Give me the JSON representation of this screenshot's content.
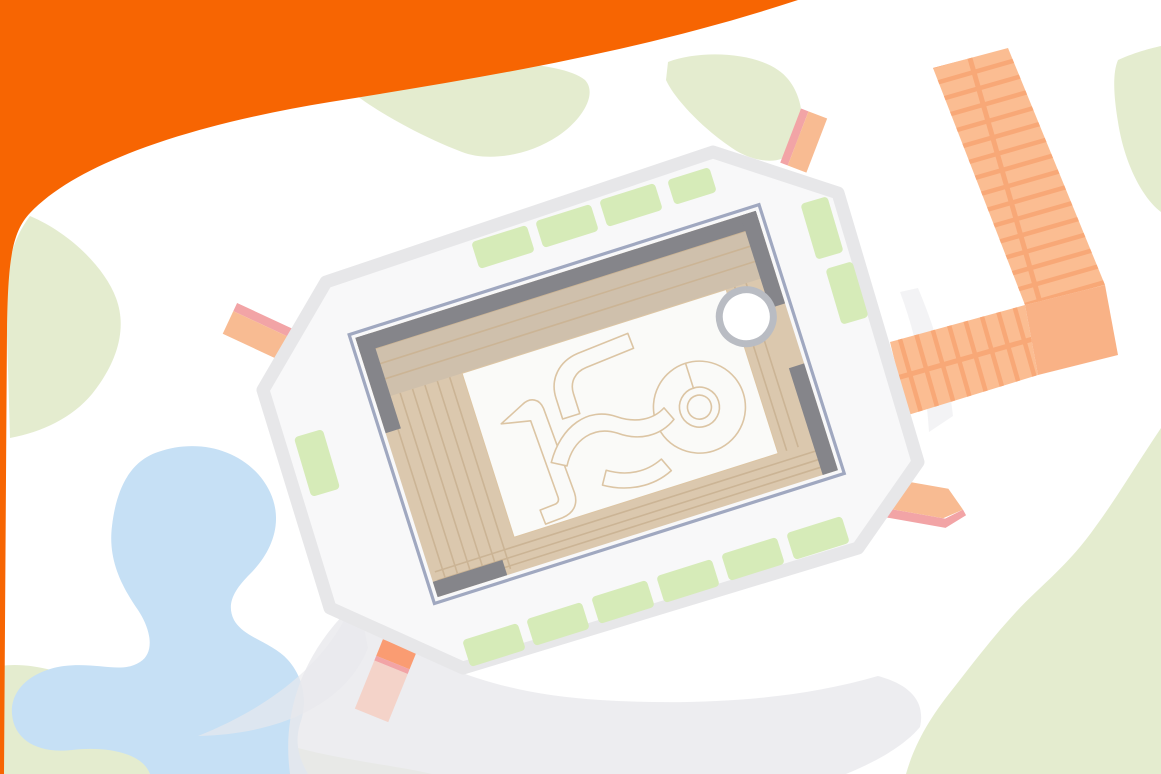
{
  "title": "Aerial site plan illustration",
  "colors": {
    "banner": "#F76502",
    "grass": "#E4ECCF",
    "planter": "#D6EBB8",
    "pond": "#C6E0F5",
    "swoosh": "#E9E9EC",
    "rim": "#E7E7E9",
    "platform": "#F8F8F9",
    "wall": "#85858A",
    "glazing": "#A0A8C0",
    "deck": "#DBC8AE",
    "deck_top": "#CFC0AC",
    "plank": "#CBB495",
    "courtyard": "#FAFAF8",
    "ribbon": "#DCC5A4",
    "ring": "#B9BCC3",
    "pier_plank": "#FBBD92",
    "pier_gap": "#F8A877",
    "pier_square": "#F9B286",
    "ramp_orange": "#F8BB92",
    "ramp_pink": "#F2A4A6",
    "ramp_bright": "#FA9C72",
    "ramp_fade": "rgba(245,201,188,0.75)"
  },
  "scene": {
    "header": "orange corner swoosh",
    "lawn_patches": 6,
    "pond_count": 1,
    "path_swooshes": 3,
    "building": {
      "platform": "octagonal white plinth",
      "structure": "rotated rectangular pavilion",
      "deck": "timber plank ring",
      "courtyard_features": [
        "curved ribbon seating",
        "spiral ground feature"
      ],
      "tree_circles": 1,
      "planters": 13,
      "ramps": 4
    },
    "boardwalk": {
      "type": "L-shaped plank pier",
      "arms": 2,
      "landing_square": 1
    }
  }
}
